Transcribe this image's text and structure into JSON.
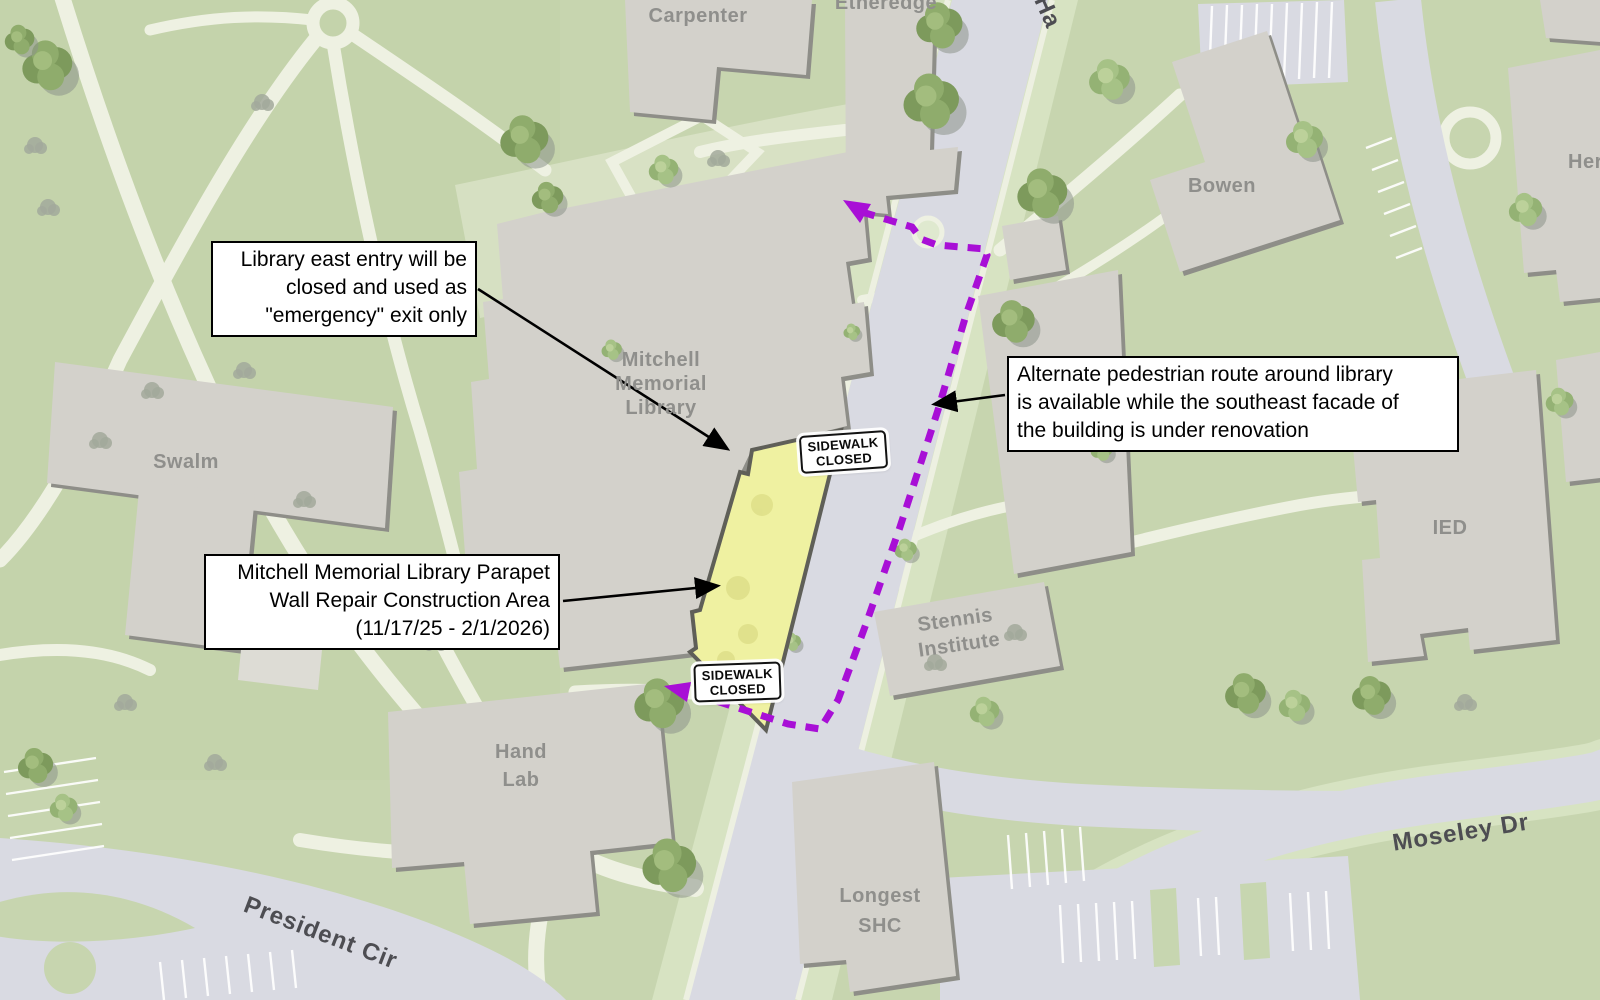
{
  "map": {
    "buildings": {
      "carpenter": "Carpenter",
      "etheredge": "Etheredge",
      "library": [
        "Mitchell",
        "Memorial",
        "Library"
      ],
      "swalm": "Swalm",
      "bowen": "Bowen",
      "herzer_partial": "Her",
      "ied": "IED",
      "stennis": [
        "Stennis",
        "Institute"
      ],
      "hand_lab": [
        "Hand",
        "Lab"
      ],
      "longest_shc": [
        "Longest",
        "SHC"
      ]
    },
    "streets": {
      "hardy_partial": "Ha",
      "moseley": "Moseley Dr",
      "president": "President Cir"
    }
  },
  "callouts": {
    "east_entry": {
      "lines": [
        "Library east entry will be",
        "closed and used as",
        "\"emergency\" exit only"
      ]
    },
    "alternate_route": {
      "lines": [
        "Alternate pedestrian route around library",
        "is available while the southeast facade of",
        "the building is under renovation"
      ]
    },
    "construction_area": {
      "lines": [
        "Mitchell Memorial Library Parapet",
        "Wall Repair Construction Area",
        "(11/17/25 - 2/1/2026)"
      ]
    }
  },
  "signs": {
    "sidewalk_closed": {
      "lines": [
        "SIDEWALK",
        "CLOSED"
      ]
    }
  },
  "legend_colors": {
    "pedestrian_route": "#a80fd6",
    "construction_fill": "#eff1a1",
    "construction_border": "#5f5f58"
  }
}
